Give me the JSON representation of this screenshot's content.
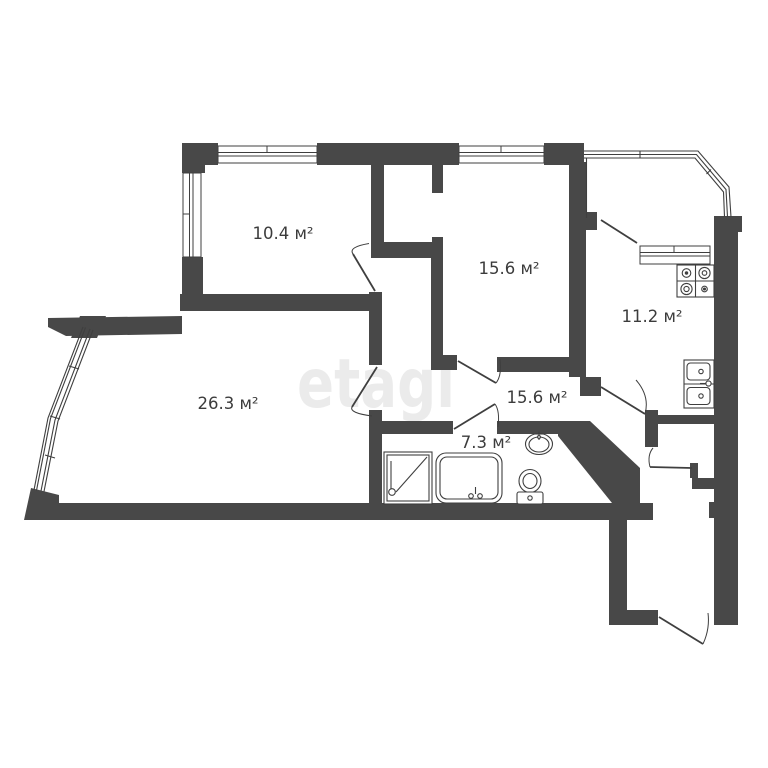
{
  "floorplan": {
    "watermark": "etagi",
    "units": "м²",
    "rooms": [
      {
        "name": "bedroom-top-left",
        "area_label": "10.4 м²"
      },
      {
        "name": "bedroom-top-right",
        "area_label": "15.6 м²"
      },
      {
        "name": "kitchen",
        "area_label": "11.2 м²"
      },
      {
        "name": "living-room",
        "area_label": "26.3 м²"
      },
      {
        "name": "hallway",
        "area_label": "15.6 м²"
      },
      {
        "name": "bathroom",
        "area_label": "7.3 м²"
      }
    ],
    "fixtures": [
      "stove",
      "kitchen-sink",
      "shower",
      "bathtub",
      "washbasin",
      "toilet"
    ],
    "colors": {
      "wall": "#484848",
      "line": "#3f3f3f",
      "label": "#3c3c3c",
      "watermark": "#ebebeb",
      "background": "#ffffff"
    }
  }
}
